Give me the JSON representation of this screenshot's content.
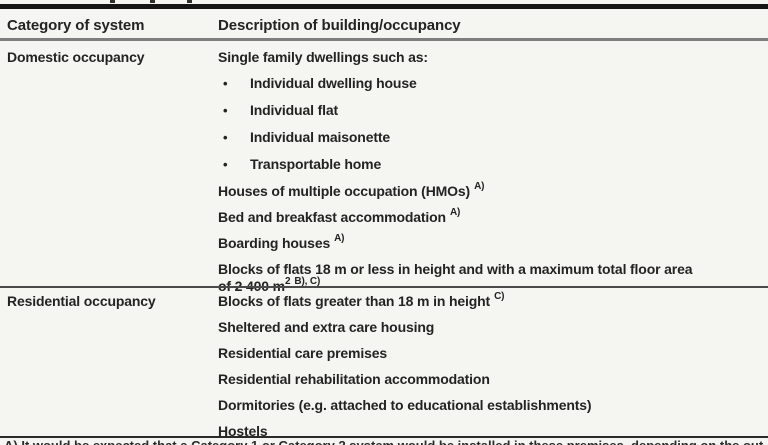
{
  "page": {
    "background": "#f5f5f1",
    "text_color": "#232323"
  },
  "table": {
    "bullet_glyph": "•",
    "columns": [
      "Category of system",
      "Description of building/occupancy"
    ],
    "sections": [
      {
        "category": "Domestic occupancy",
        "rows": [
          {
            "bullet": false,
            "lines": [
              [
                {
                  "text": "Single family dwellings such as:",
                  "sup": false
                }
              ]
            ]
          },
          {
            "bullet": true,
            "lines": [
              [
                {
                  "text": "Individual dwelling house",
                  "sup": false
                }
              ]
            ]
          },
          {
            "bullet": true,
            "lines": [
              [
                {
                  "text": "Individual flat",
                  "sup": false
                }
              ]
            ]
          },
          {
            "bullet": true,
            "lines": [
              [
                {
                  "text": "Individual maisonette",
                  "sup": false
                }
              ]
            ]
          },
          {
            "bullet": true,
            "lines": [
              [
                {
                  "text": "Transportable home",
                  "sup": false
                }
              ]
            ]
          },
          {
            "bullet": false,
            "lines": [
              [
                {
                  "text": "Houses of multiple occupation (HMOs)",
                  "sup": false
                },
                {
                  "text": "A)",
                  "sup": true,
                  "gap": true
                }
              ]
            ]
          },
          {
            "bullet": false,
            "lines": [
              [
                {
                  "text": "Bed and breakfast accommodation",
                  "sup": false
                },
                {
                  "text": "A)",
                  "sup": true,
                  "gap": true
                }
              ]
            ]
          },
          {
            "bullet": false,
            "lines": [
              [
                {
                  "text": "Boarding houses",
                  "sup": false
                },
                {
                  "text": "A)",
                  "sup": true,
                  "gap": true
                }
              ]
            ]
          },
          {
            "bullet": false,
            "lines": [
              [
                {
                  "text": "Blocks of flats 18 m or less in height and with a maximum total floor area",
                  "sup": false
                }
              ],
              [
                {
                  "text": "of 2 400 m",
                  "sup": false
                },
                {
                  "text": "2",
                  "sup": true,
                  "gap": false
                },
                {
                  "text": "B), C)",
                  "sup": true,
                  "gap": true
                }
              ]
            ]
          }
        ]
      },
      {
        "category": "Residential occupancy",
        "rows": [
          {
            "bullet": false,
            "lines": [
              [
                {
                  "text": "Blocks of flats greater than 18 m in height",
                  "sup": false
                },
                {
                  "text": "C)",
                  "sup": true,
                  "gap": true
                }
              ]
            ]
          },
          {
            "bullet": false,
            "lines": [
              [
                {
                  "text": "Sheltered and extra care housing",
                  "sup": false
                }
              ]
            ]
          },
          {
            "bullet": false,
            "lines": [
              [
                {
                  "text": "Residential care premises",
                  "sup": false
                }
              ]
            ]
          },
          {
            "bullet": false,
            "lines": [
              [
                {
                  "text": "Residential rehabilitation accommodation",
                  "sup": false
                }
              ]
            ]
          },
          {
            "bullet": false,
            "lines": [
              [
                {
                  "text": "Dormitories (e.g. attached to educational establishments)",
                  "sup": false
                }
              ]
            ]
          },
          {
            "bullet": false,
            "lines": [
              [
                {
                  "text": "Hostels",
                  "sup": false
                }
              ]
            ]
          }
        ]
      }
    ],
    "footnote_fragment": "A) It would be expected that a Category 1 or Category 2 system would be installed in these premises, depending on the outcome of a risk assessment."
  }
}
